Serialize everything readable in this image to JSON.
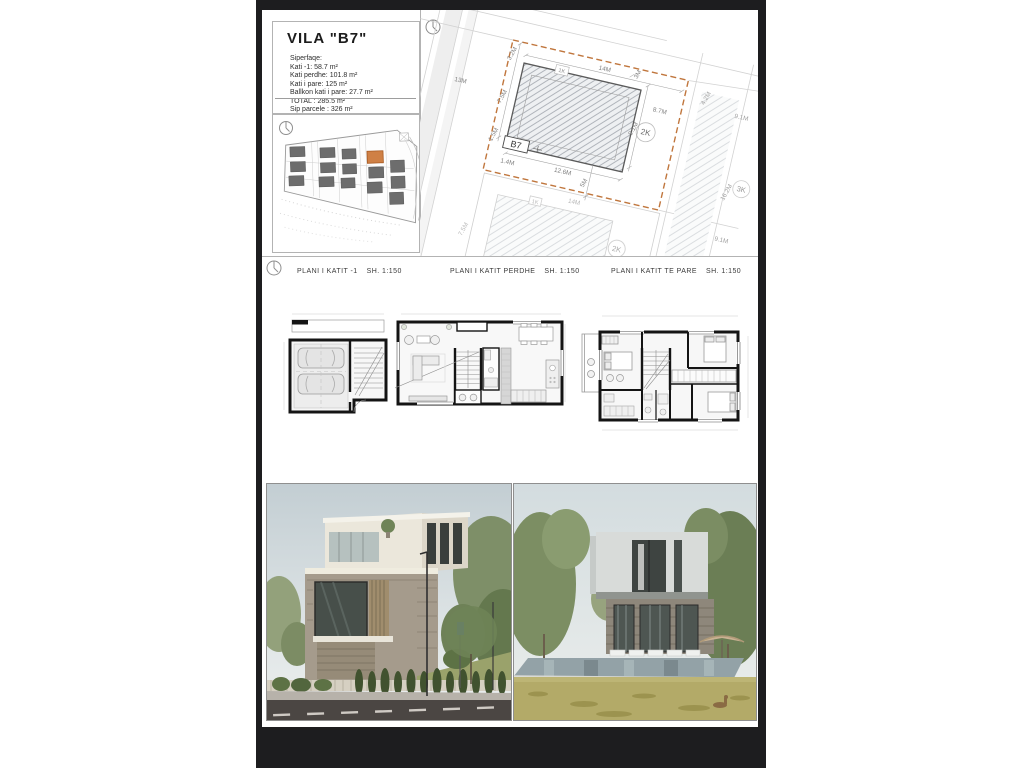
{
  "colors": {
    "letterbox": "#1d1d1f",
    "accent_orange": "#c0763d",
    "sheet": "#ffffff"
  },
  "sheet": {
    "title": "VILA \"B7\"",
    "areas": {
      "heading": "Siperfaqe:",
      "lines": [
        "Kati -1: 58.7 m²",
        "Kati perdhe: 101.8 m²",
        "Kati i pare: 125 m²",
        "Ballkon kati i pare: 27.7 m²",
        "TOTAL : 285.5 m²",
        "Sip parcele : 326 m²"
      ]
    }
  },
  "site_plan": {
    "lots": {
      "b7": "B7",
      "k1": "1K",
      "k2": "2K",
      "k3": "3K",
      "k1b": "1K",
      "k2b": "2K"
    },
    "dims": {
      "top": "14M",
      "top_left": "3.2M",
      "top_right": "3M",
      "left_upper": "7.5M",
      "left_lower": "1.5M",
      "right": "8.7M",
      "inner_right": "9.1M",
      "bottom": "12.6M",
      "bottom_left": "1.4M",
      "below": "5M",
      "road": "13M",
      "right_a": "4.2M",
      "right_b": "9.1M",
      "right_c": "16.2M",
      "right_d": "9.1M",
      "lower_top": "14M",
      "lower_left": "7.5M"
    }
  },
  "floor_plans": [
    {
      "label": "PLANI I KATIT -1",
      "scale": "SH. 1:150"
    },
    {
      "label": "PLANI I KATIT PERDHE",
      "scale": "SH. 1:150"
    },
    {
      "label": "PLANI I KATIT TE PARE",
      "scale": "SH. 1:150"
    }
  ]
}
